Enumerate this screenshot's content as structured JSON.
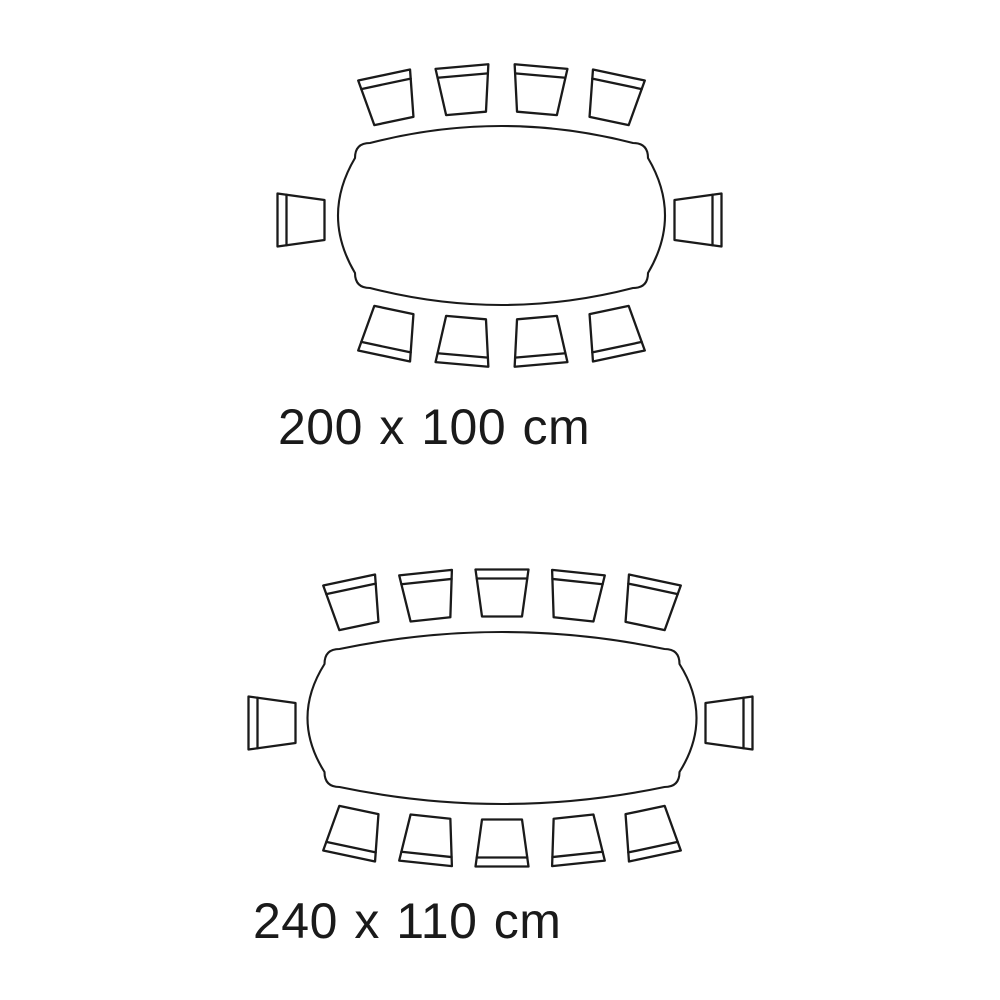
{
  "title": "dining table seating capacity diagrams",
  "background": "#ffffff",
  "line_color": "#1a1a1a",
  "chair_shape": {
    "back_width": 53,
    "front_width": 40,
    "depth": 47,
    "backrest_inset": 9,
    "stroke_width": 2.3
  },
  "table_style": {
    "corner": 32,
    "bulge": 17,
    "stroke_width": 2.1
  },
  "diagrams": [
    {
      "name": "table-200x100",
      "label": "200 x 100 cm",
      "table_size_cm": {
        "length": 200,
        "width": 100
      },
      "seat_count": 10,
      "table": {
        "cx": 501.5,
        "cy": 215.5,
        "width": 327,
        "height": 179
      },
      "label_pos": {
        "x": 278,
        "y": 444,
        "font_size": 50
      },
      "chairs": [
        {
          "x": 389,
          "y": 98,
          "rot": -12
        },
        {
          "x": 464,
          "y": 90,
          "rot": -5
        },
        {
          "x": 539,
          "y": 90,
          "rot": 5
        },
        {
          "x": 614,
          "y": 98,
          "rot": 12
        },
        {
          "x": 698,
          "y": 220,
          "rot": 90
        },
        {
          "x": 614,
          "y": 333,
          "rot": 168
        },
        {
          "x": 539,
          "y": 341,
          "rot": 175
        },
        {
          "x": 464,
          "y": 341,
          "rot": 185
        },
        {
          "x": 389,
          "y": 333,
          "rot": 192
        },
        {
          "x": 301,
          "y": 220,
          "rot": -90
        }
      ]
    },
    {
      "name": "table-240x110",
      "label": "240 x 110 cm",
      "table_size_cm": {
        "length": 240,
        "width": 110
      },
      "seat_count": 12,
      "table": {
        "cx": 502,
        "cy": 718,
        "width": 389,
        "height": 172
      },
      "label_pos": {
        "x": 253,
        "y": 938,
        "font_size": 50
      },
      "chairs": [
        {
          "x": 354,
          "y": 603,
          "rot": -12
        },
        {
          "x": 428,
          "y": 596,
          "rot": -6
        },
        {
          "x": 502,
          "y": 593,
          "rot": 0
        },
        {
          "x": 576,
          "y": 596,
          "rot": 6
        },
        {
          "x": 650,
          "y": 603,
          "rot": 12
        },
        {
          "x": 729,
          "y": 723,
          "rot": 90
        },
        {
          "x": 650,
          "y": 833,
          "rot": 168
        },
        {
          "x": 576,
          "y": 840,
          "rot": 174
        },
        {
          "x": 502,
          "y": 843,
          "rot": 180
        },
        {
          "x": 428,
          "y": 840,
          "rot": 186
        },
        {
          "x": 354,
          "y": 833,
          "rot": 192
        },
        {
          "x": 272,
          "y": 723,
          "rot": -90
        }
      ]
    }
  ]
}
